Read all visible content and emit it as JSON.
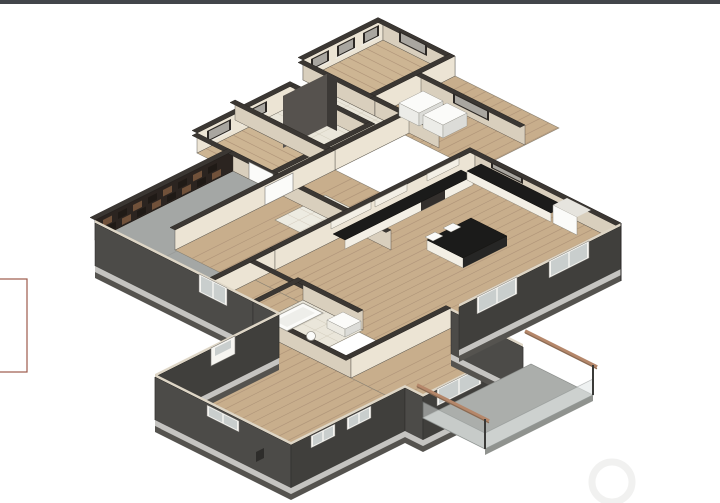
{
  "scene": {
    "type": "3d-isometric-floor-plan-rendering",
    "style": "architectural-bim-cutaway",
    "rooms": [
      {
        "name": "garage",
        "floor": "concrete"
      },
      {
        "name": "bedroom-upper-left",
        "floor": "wood-plank"
      },
      {
        "name": "bedroom-top",
        "floor": "wood-plank"
      },
      {
        "name": "laundry",
        "floor": "tile"
      },
      {
        "name": "hallway",
        "floor": "wood-plank"
      },
      {
        "name": "foyer",
        "floor": "tile-grid"
      },
      {
        "name": "great-room-kitchen",
        "floor": "wood-plank"
      },
      {
        "name": "bathroom",
        "floor": "tile"
      },
      {
        "name": "bedroom-lower-right",
        "floor": "wood-plank"
      },
      {
        "name": "master-bedroom",
        "floor": "wood-plank"
      },
      {
        "name": "deck",
        "floor": "concrete"
      },
      {
        "name": "dining-nook",
        "floor": "wood-plank"
      }
    ],
    "features": [
      "kitchen-island",
      "l-shaped-counter",
      "bathtub",
      "washer-dryer",
      "garage-door-panel-wall",
      "deck-pergola-beams",
      "glass-deck-rail"
    ]
  },
  "palette": {
    "wood": "#c8ae8c",
    "woodLight": "#cdb593",
    "plank": "#b2977b",
    "tile": "#eae6da",
    "tileLine": "#d6d0c0",
    "foyerTile": "#edebe1",
    "garageFloor": "#a4a7a5",
    "garageSeam": "#989b99",
    "deckFloor": "#abaeab",
    "wallLight": "#ece4d4",
    "wallMed": "#d9cfbd",
    "capDark": "#3b3733",
    "capLight": "#ded6c6",
    "extSW": "#4c4b48",
    "extSE": "#403f3c",
    "trimLight": "#c5c4c1",
    "trimDark": "#55534f",
    "garageDoor": "#2b2420",
    "slat": "#70513a",
    "slatDark": "#1f1a16",
    "cabinet": "#f3efe5",
    "counter": "#1b1b1a",
    "counterDark": "#262625",
    "frameWhite": "#f6f5f1",
    "glass": "#c9cecd",
    "glassDark": "#8e928f",
    "winDark": "#2c2825",
    "winPane": "#a9a6a0",
    "sill": "#f0ede6",
    "white": "#fbfbf9",
    "applianceSide": "#dcdcd8",
    "beam": "#b5876a",
    "beamDark": "#8a6a52",
    "post": "#3a3a38",
    "railGlass": "#e4e9e8"
  },
  "overlays": {
    "top_bar_color": "#42454a",
    "left_box_border": "#9c5b4b",
    "watermark_color": "#f1f1f0"
  }
}
